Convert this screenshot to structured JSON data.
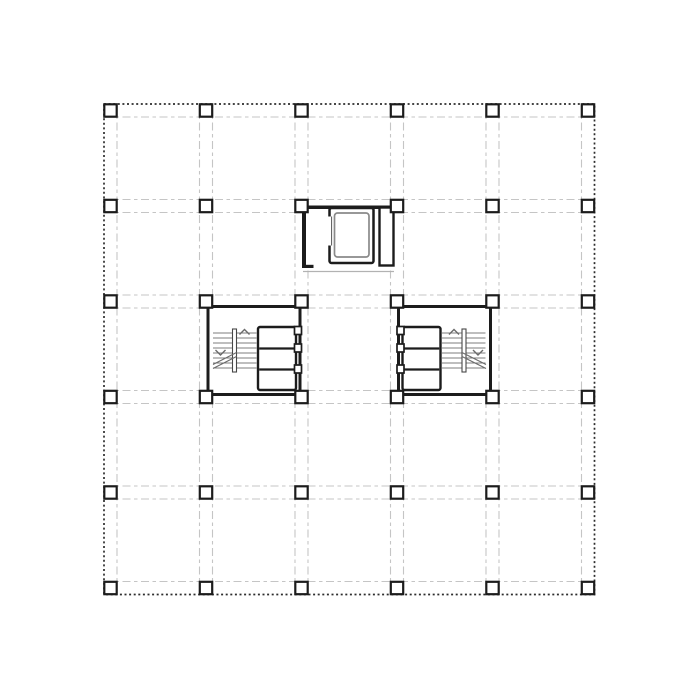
{
  "document": {
    "type": "architectural-floor-plan",
    "description": "structural floor plan with column grid, two stair cores and top service core",
    "visible_text": ""
  },
  "canvas": {
    "width": 700,
    "height": 700,
    "background": "#ffffff"
  },
  "palette": {
    "background": "#ffffff",
    "wall": "#1c1c1c",
    "column_fill": "#ffffff",
    "beam_line": "#c5c5c5",
    "boundary_line": "#2d2d2d",
    "tread": "#7e7e7e",
    "marking": "#6a6a6a",
    "rail": "#474747",
    "car_liner": "#8a8a8a",
    "landing": "#b2b2b2",
    "door_line": "#555555"
  },
  "grid": {
    "x_centers": [
      110.5,
      206,
      301.5,
      397,
      492.5,
      588
    ],
    "y_centers": [
      110.5,
      206,
      301.5,
      397,
      492.5,
      588
    ],
    "beam_half_gap": 6.5,
    "bounds": {
      "x1": 104,
      "y1": 104,
      "x2": 594.5,
      "y2": 594.5
    },
    "column_size": 12.4,
    "beam_dash": "8 3.5 3.5 3.5",
    "boundary_dash": "2 2.6"
  },
  "elevator_core": {
    "clear_fill": [
      301,
      204,
      396,
      269
    ],
    "walls": {
      "top": [
        302,
        205.5,
        395,
        209
      ],
      "left": [
        302,
        205.5,
        306,
        268
      ],
      "hook": [
        302,
        264.8,
        313.5,
        268
      ]
    },
    "right_duct": [
      379.5,
      207.5,
      393.5,
      265.5
    ],
    "shaft_box": [
      329.5,
      208,
      373.5,
      263
    ],
    "door_gap": [
      327.6,
      216.5,
      331.6,
      245.5
    ],
    "door_line": [
      331.6,
      216.5,
      331.6,
      245.5
    ],
    "car_liner": [
      334.5,
      213,
      369,
      257
    ],
    "landing_line": [
      303,
      271.5,
      394,
      271.5
    ]
  },
  "stair_cores": [
    {
      "side": "left",
      "wall_box": [
        208,
        306.5,
        300,
        394.5
      ],
      "shaft_box": [
        258,
        327,
        296,
        390
      ],
      "shaft_dividers_y": [
        348.5,
        369.5
      ],
      "door_jambs": {
        "x": [
          294.5,
          301.5
        ],
        "y_pairs": [
          [
            326.5,
            334.5
          ],
          [
            344,
            352
          ],
          [
            365,
            373
          ]
        ]
      },
      "treads": {
        "x1": 213,
        "x2": 256.5,
        "ys": [
          333,
          338,
          343,
          348,
          353,
          358,
          363,
          368
        ]
      },
      "rail_box": [
        232.5,
        329,
        236.5,
        372
      ],
      "arrow_up_apex": [
        244.5,
        329.5
      ],
      "arrow_down_apex": [
        220.5,
        355
      ],
      "arrow_half": 5,
      "break_lines": [
        [
          213,
          364.5,
          236.5,
          352.5
        ],
        [
          213,
          368.5,
          236.5,
          356.5
        ]
      ]
    },
    {
      "side": "right",
      "wall_box": [
        398.5,
        306.5,
        490.5,
        394.5
      ],
      "shaft_box": [
        402.5,
        327,
        440.5,
        390
      ],
      "shaft_dividers_y": [
        348.5,
        369.5
      ],
      "door_jambs": {
        "x": [
          397,
          404
        ],
        "y_pairs": [
          [
            326.5,
            334.5
          ],
          [
            344,
            352
          ],
          [
            365,
            373
          ]
        ]
      },
      "treads": {
        "x1": 442,
        "x2": 485.5,
        "ys": [
          333,
          338,
          343,
          348,
          353,
          358,
          363,
          368
        ]
      },
      "rail_box": [
        462,
        329,
        466,
        372
      ],
      "arrow_up_apex": [
        454,
        329.5
      ],
      "arrow_down_apex": [
        478,
        355
      ],
      "arrow_half": 5,
      "break_lines": [
        [
          462,
          352.5,
          486,
          364.5
        ],
        [
          462,
          356.5,
          486,
          368.5
        ]
      ]
    }
  ]
}
